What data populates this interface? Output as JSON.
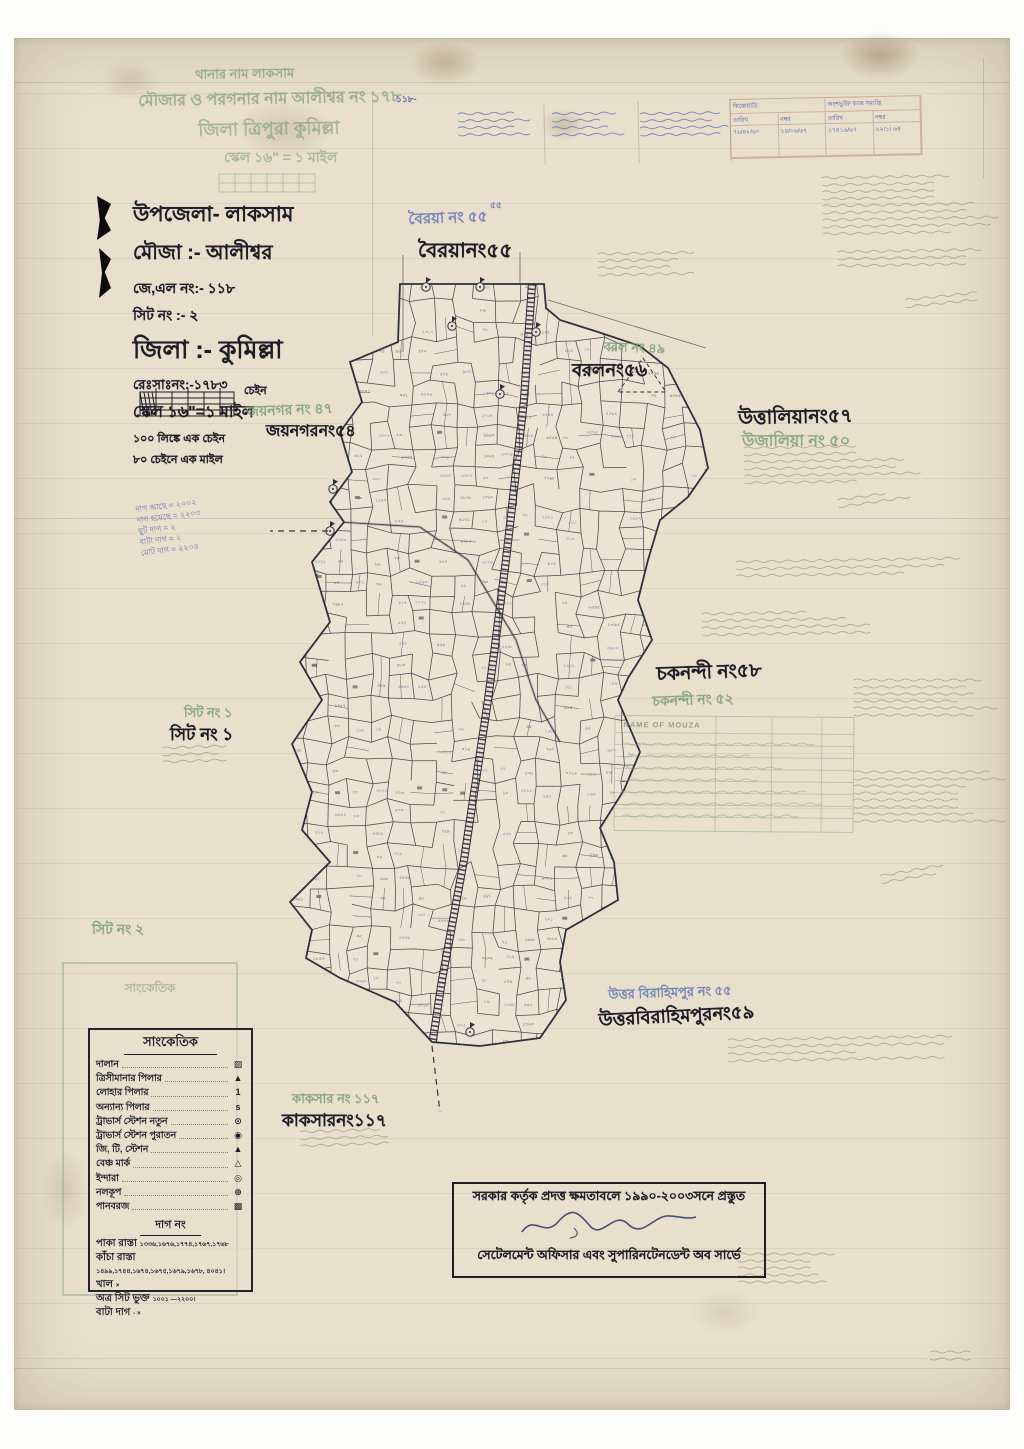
{
  "title_block": {
    "line1": "উপজেলা- লাকসাম",
    "line2": "মৌজা :- আলীশ্বর",
    "line3": "জে,এল নং:- ১১৮",
    "line4": "সিট নং :- ২",
    "line5": "জিলা :- কুমিল্লা",
    "line6": "রেঃসাঃনং:-১৭৮৩",
    "line7": "স্কেল ১৬\"=১ মাইল",
    "line8": "১০০ লিঙ্কে এক চেইন",
    "line9": "৮০ চেইনে এক মাইল",
    "scale_unit": "চেইন"
  },
  "ghost_title": {
    "line1": "থানার নাম লাকসাম",
    "line2": "মৌজার ও পরগনার নাম আলীশ্বর নং ১৭৮",
    "line3": "জিলা ত্রিপুরা কুমিল্লা",
    "line4": "স্কেল ১৬\" = ১ মাইল"
  },
  "marginal_marks": {
    "blue_jl": "১১৮-",
    "blue_55": "৫৫"
  },
  "neighbor_labels": {
    "boiroya_ghost": "বৈরয়া নং ৫৫",
    "boiroya": "বৈরয়ানং৫৫",
    "borol_ghost": "বরল নং ৪৯",
    "borol": "বরলনং৫৬",
    "uttalia": "উত্তালিয়ানং৫৭",
    "uttalia_ghost": "উজালিয়া নং ৫০",
    "joynagar_ghost": "জয়নগর নং ৪৭",
    "joynagar": "জয়নগরনং৫৪",
    "chawknondi": "চকনন্দী নং৫৮",
    "chawknondi_ghost": "চকনন্দী নং ৫২",
    "sheet1_ghost": "সিট নং ১",
    "sheet1": "সিট নং ১",
    "sheet2_ghost": "সিট নং ২",
    "birahimpur_ghost": "উত্তর বিরাহিমপুর নং ৫৫",
    "birahimpur": "উত্তরবিরাহিমপুরনং৫৯",
    "kaksar_ghost": "কাকসার নং ১১৭",
    "kaksar": "কাকসারনং১১৭"
  },
  "legend": {
    "title": "সাংকেতিক",
    "rows": [
      {
        "label": "দালান",
        "symbol": "▨"
      },
      {
        "label": "ত্রিসীমানার পিলার",
        "symbol": "▲"
      },
      {
        "label": "লোহার পিলার",
        "symbol": "1"
      },
      {
        "label": "অন্যান্য পিলার",
        "symbol": "s"
      },
      {
        "label": "ট্রাভার্স স্টেশন নতুন",
        "symbol": "⊙"
      },
      {
        "label": "ট্রাভার্স স্টেশন পুরাতন",
        "symbol": "◉"
      },
      {
        "label": "জি, টি, স্টেশন",
        "symbol": "▲"
      },
      {
        "label": "বেঞ্চ মার্ক",
        "symbol": "△"
      },
      {
        "label": "ইন্দারা",
        "symbol": "◎"
      },
      {
        "label": "নলকূপ",
        "symbol": "⊕"
      },
      {
        "label": "পানবরজ",
        "symbol": "▩"
      }
    ],
    "dag_title": "দাগ নং",
    "dag_rows": [
      {
        "label": "পাকা রাস্তা",
        "value": "১৩৩৬,১৬৭৬,১৭৭৪,১৭৬৭,১৭৬৮"
      },
      {
        "label": "কাঁচা রাস্তা",
        "value": "১৪৯৯,১৭৪৪,১৬৭৪,১৬৭৫,১৬৭৯,১৬৭৮, ৪০৪১।"
      },
      {
        "label": "খাল",
        "value": "×"
      },
      {
        "label": "অত্র সিট ভুক্ত",
        "value": "১০০১ —২২০০।"
      },
      {
        "label": "বাটা দাগ",
        "value": "- ×"
      }
    ]
  },
  "stamp": {
    "line1": "সরকার কর্তৃক প্রদত্ত ক্ষমতাবলে ১৯৯০-২০০৩সনে প্রস্তুত",
    "line2": "সেটেলমেন্ট অফিসার এবং সুপারিনটেনডেন্ট অব সার্ভে"
  },
  "hand_table": {
    "group1": "কিস্তোয়ারি",
    "group2": "অংশভুক্তি কাজ সমাপ্তি",
    "sub_date1": "তারিখ",
    "sub_no1": "নম্বর",
    "sub_date2": "তারিখ",
    "sub_no2": "নম্বর",
    "val1": "৭৬/৪৮/৬০",
    "val2": "১৪/০৬/৬৭",
    "val3": "১৭৪১৬/৬৭",
    "val4": "২২।১। ৬৪"
  },
  "mouza_table": {
    "header": "NAME OF MOUZA"
  },
  "notes_left": [
    "দাগ আছে = ২০০২",
    "দাগ হয়েছে = ২২০৩",
    "ছুট দাগ = ২",
    "বাটা দাগ = ২",
    "মোট দাগ = ২২০৪"
  ],
  "map": {
    "digits": "০১২৩৪৫৬৭৮৯",
    "outline": [
      [
        400,
        284
      ],
      [
        544,
        284
      ],
      [
        546,
        308
      ],
      [
        560,
        320
      ],
      [
        598,
        332
      ],
      [
        640,
        346
      ],
      [
        668,
        368
      ],
      [
        700,
        430
      ],
      [
        708,
        468
      ],
      [
        688,
        497
      ],
      [
        660,
        520
      ],
      [
        648,
        560
      ],
      [
        638,
        600
      ],
      [
        652,
        640
      ],
      [
        628,
        678
      ],
      [
        618,
        700
      ],
      [
        640,
        752
      ],
      [
        624,
        790
      ],
      [
        600,
        828
      ],
      [
        614,
        862
      ],
      [
        618,
        900
      ],
      [
        566,
        930
      ],
      [
        560,
        962
      ],
      [
        566,
        1000
      ],
      [
        540,
        1038
      ],
      [
        480,
        1046
      ],
      [
        432,
        1042
      ],
      [
        395,
        1002
      ],
      [
        340,
        978
      ],
      [
        306,
        958
      ],
      [
        312,
        930
      ],
      [
        290,
        902
      ],
      [
        330,
        862
      ],
      [
        302,
        830
      ],
      [
        312,
        792
      ],
      [
        292,
        744
      ],
      [
        322,
        700
      ],
      [
        300,
        662
      ],
      [
        330,
        622
      ],
      [
        312,
        562
      ],
      [
        344,
        522
      ],
      [
        330,
        502
      ],
      [
        352,
        472
      ],
      [
        340,
        432
      ],
      [
        362,
        402
      ],
      [
        350,
        362
      ],
      [
        398,
        342
      ]
    ],
    "railway": [
      [
        532,
        284
      ],
      [
        524,
        400
      ],
      [
        506,
        560
      ],
      [
        488,
        700
      ],
      [
        464,
        860
      ],
      [
        442,
        980
      ],
      [
        432,
        1046
      ]
    ],
    "roads": [
      [
        [
          340,
          522
        ],
        [
          420,
          527
        ],
        [
          468,
          560
        ]
      ],
      [
        [
          468,
          560
        ],
        [
          516,
          640
        ],
        [
          536,
          700
        ],
        [
          560,
          742
        ]
      ]
    ],
    "stations": [
      [
        426,
        287
      ],
      [
        480,
        287
      ],
      [
        452,
        326
      ],
      [
        536,
        332
      ],
      [
        333,
        489
      ],
      [
        330,
        531
      ],
      [
        500,
        394
      ],
      [
        470,
        1032
      ]
    ],
    "extra_dashed": [
      [
        [
          328,
          531
        ],
        [
          270,
          531
        ]
      ],
      [
        [
          432,
          1046
        ],
        [
          440,
          1112
        ]
      ]
    ],
    "extra_solid": [
      [
        [
          548,
          300
        ],
        [
          706,
          348
        ]
      ],
      [
        [
          403,
          255
        ],
        [
          403,
          352
        ]
      ],
      [
        [
          520,
          252
        ],
        [
          520,
          284
        ]
      ]
    ],
    "triangle": [
      [
        618,
        392
      ],
      [
        643,
        358
      ],
      [
        666,
        392
      ]
    ]
  }
}
